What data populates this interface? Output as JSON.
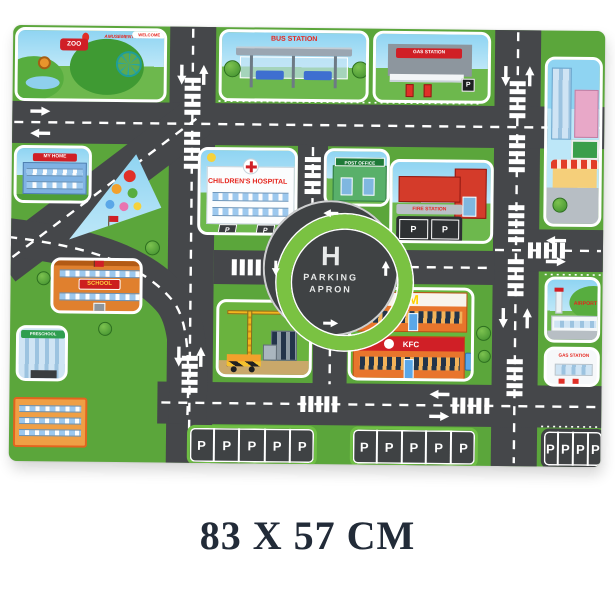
{
  "caption": "83 X 57 CM",
  "mat": {
    "zoo": {
      "sign": "ZOO",
      "park_sign": "AMUSEMENT PARK",
      "banner": "WELCOME"
    },
    "bus_station": {
      "sign": "BUS STATION"
    },
    "gas_station_top": {
      "sign": "GAS STATION",
      "p": "P"
    },
    "my_home": {
      "sign": "MY HOME"
    },
    "hospital": {
      "sign": "CHILDREN'S HOSPITAL",
      "p": "P"
    },
    "post_office": {
      "sign": "POST OFFICE"
    },
    "fire_station": {
      "sign": "FIRE STATION",
      "p": "P"
    },
    "school": {
      "sign": "SCHOOL"
    },
    "preschool": {
      "sign": "PRESCHOOL"
    },
    "roundabout": {
      "letter": "H",
      "word1": "PARKING",
      "word2": "APRON"
    },
    "mcdonalds": {
      "logo": "M"
    },
    "kfc": {
      "sign": "KFC"
    },
    "airport": {
      "sign": "AIRPORT"
    },
    "gas_station_bottom": {
      "sign": "GAS STATION"
    },
    "parking": {
      "stall": "P"
    }
  },
  "colors": {
    "road": "#45474A",
    "grass": "#5BA63B",
    "sky": "#8FD4F2",
    "ring_green": "#7AC242",
    "sign_red": "#D8281C",
    "line_white": "#FFFFFF"
  }
}
